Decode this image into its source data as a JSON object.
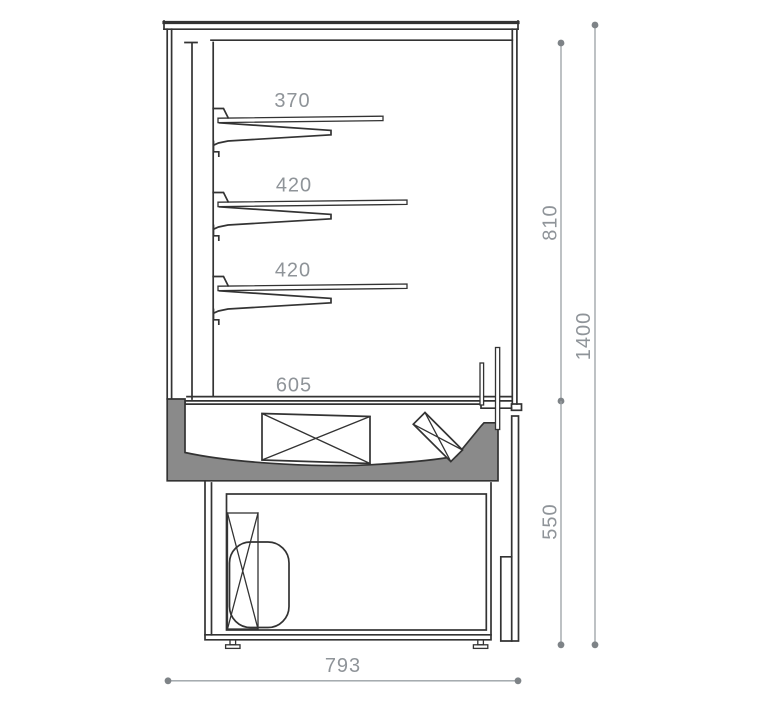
{
  "colors": {
    "line": "#333333",
    "tray_fill": "#8a8a8a",
    "dimension_line": "#9aa0a5",
    "dimension_text": "#8f9499",
    "background": "#ffffff"
  },
  "dimensions": {
    "shelf_top_depth": "370",
    "shelf_middle_depth": "420",
    "shelf_bottom_depth": "420",
    "base_shelf_depth": "605",
    "opening_height": "810",
    "total_height": "1400",
    "base_height": "550",
    "total_depth": "793"
  }
}
